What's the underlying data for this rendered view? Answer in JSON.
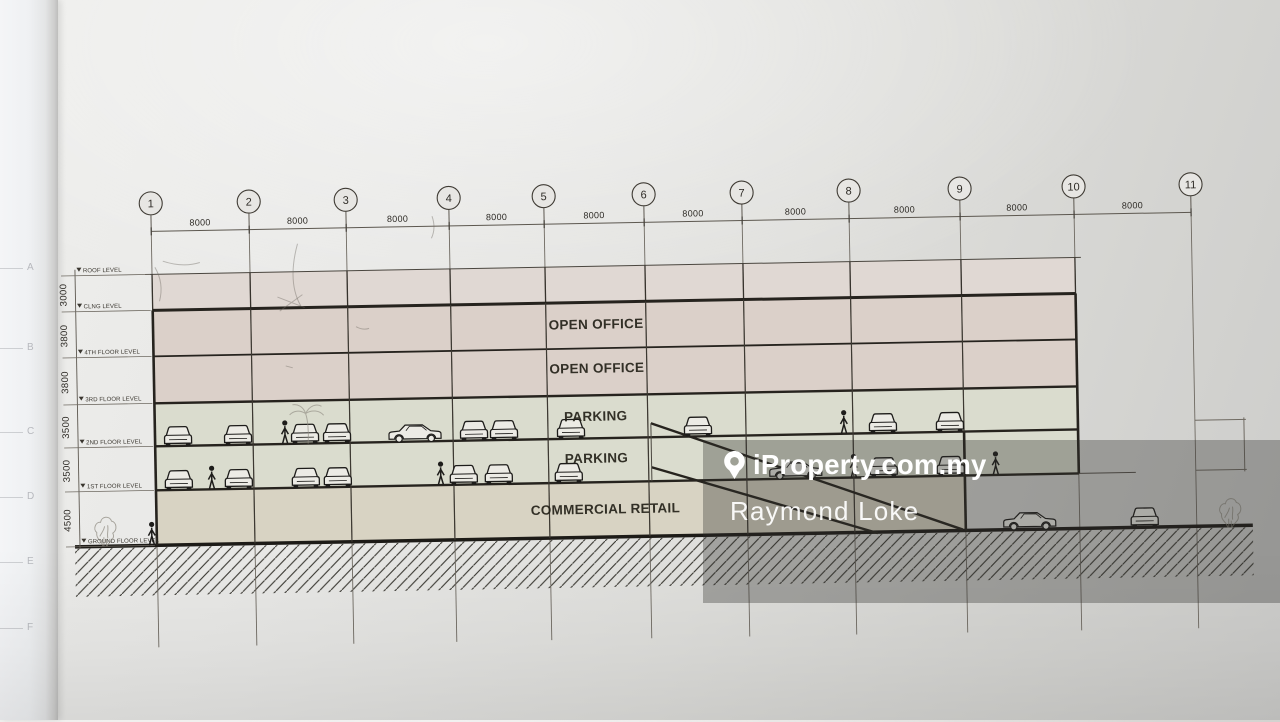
{
  "colors": {
    "paper": "#e7e6e3",
    "roof_fill": "#e0d8d3",
    "office_fill": "#dbd0c9",
    "parking_fill": "#dadcce",
    "retail_fill": "#d8d3c3",
    "ink": "#26231e",
    "pencil": "#8f8b81",
    "watermark_text": "#ffffff"
  },
  "drawing": {
    "grid_numbers": [
      "1",
      "2",
      "3",
      "4",
      "5",
      "6",
      "7",
      "8",
      "9",
      "10",
      "11"
    ],
    "grid_x": [
      157,
      255,
      352,
      455,
      550,
      650,
      748,
      855,
      966,
      1080,
      1197
    ],
    "bay_dims": [
      "8000",
      "8000",
      "8000",
      "8000",
      "8000",
      "8000",
      "8000",
      "8000",
      "8000",
      "8000"
    ],
    "levels": [
      {
        "label": "ROOF LEVEL",
        "y": 275
      },
      {
        "label": "CLNG LEVEL",
        "y": 311
      },
      {
        "label": "4TH FLOOR LEVEL",
        "y": 357
      },
      {
        "label": "3RD FLOOR LEVEL",
        "y": 404
      },
      {
        "label": "2ND FLOOR LEVEL",
        "y": 447
      },
      {
        "label": "1ST FLOOR LEVEL",
        "y": 491
      },
      {
        "label": "GROUND FLOOR LEVEL",
        "y": 546
      }
    ],
    "level_dims": [
      "3000",
      "3800",
      "3800",
      "3500",
      "3500",
      "4500"
    ],
    "floor_labels": [
      {
        "text": "OPEN OFFICE",
        "x": 600,
        "y": 333
      },
      {
        "text": "OPEN OFFICE",
        "x": 600,
        "y": 377
      },
      {
        "text": "PARKING",
        "x": 598,
        "y": 425
      },
      {
        "text": "PARKING",
        "x": 598,
        "y": 467
      },
      {
        "text": "COMMERCIAL RETAIL",
        "x": 606,
        "y": 518
      }
    ],
    "cars_front_upper": [
      180,
      240,
      307,
      339,
      476,
      506,
      573,
      700,
      885,
      952
    ],
    "cars_side_upper": [
      417
    ],
    "cars_front_lower": [
      180,
      240,
      307,
      339,
      465,
      500,
      570,
      885,
      952
    ],
    "cars_side_lower": [
      797
    ],
    "cars_front_ground": [
      1145
    ],
    "cars_side_ground": [
      1030
    ],
    "people_upper": [
      287,
      846
    ],
    "people_lower": [
      213,
      442,
      855,
      997
    ],
    "people_ground": [
      152
    ],
    "margin_letters": [
      "A",
      "B",
      "C",
      "D",
      "E",
      "F"
    ]
  },
  "watermark": {
    "brand": "iProperty.com.my",
    "agent": "Raymond Loke"
  }
}
